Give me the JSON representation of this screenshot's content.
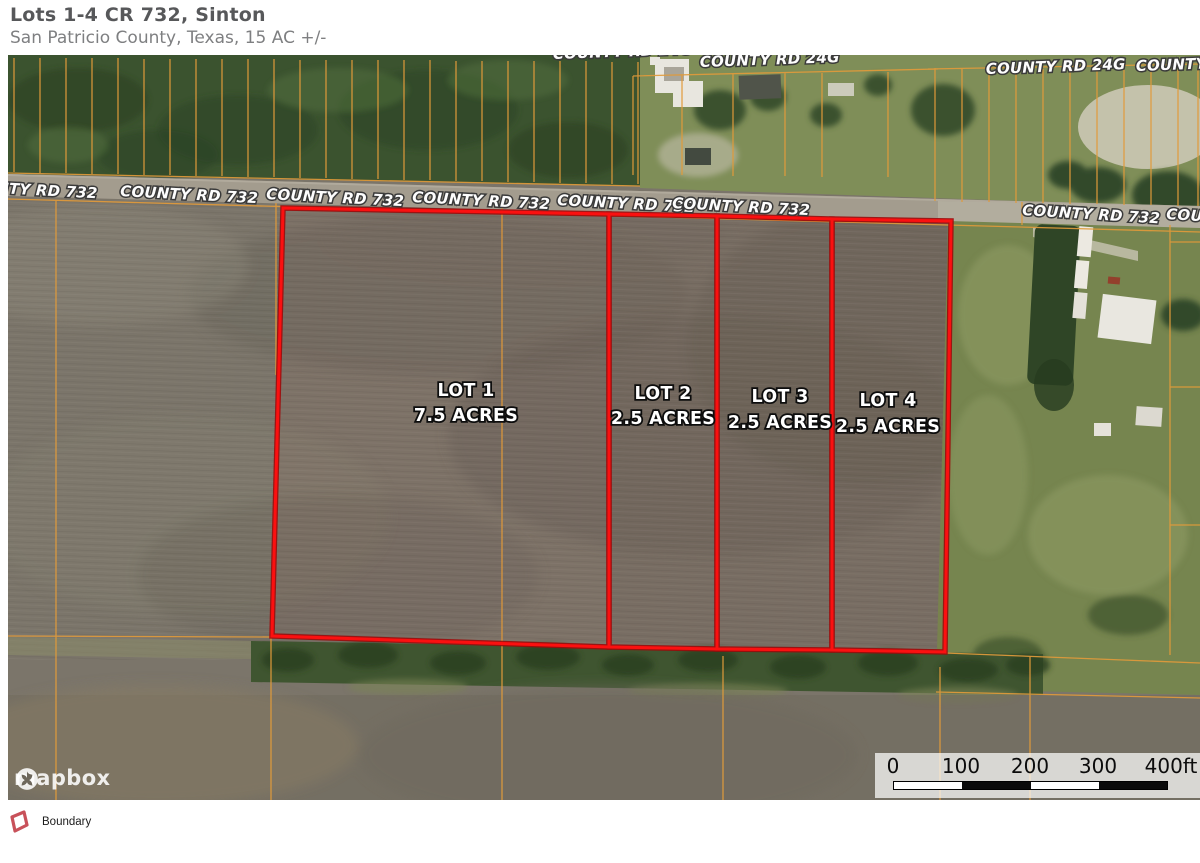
{
  "header": {
    "title": "Lots 1-4 CR 732, Sinton",
    "subtitle": "San Patricio County, Texas, 15 AC +/-"
  },
  "map": {
    "road_24g_labels": [
      "COUNTY RD 24G",
      "COUNTY RD 24G",
      "COUNTY RD 24G",
      "COUNTY"
    ],
    "road_732_labels": [
      "NTY RD 732",
      "COUNTY RD 732",
      "COUNTY RD 732",
      "COUNTY RD 732",
      "COUNTY RD 732",
      "COUNTY RD 732",
      "COUNTY RD 732",
      "COU"
    ],
    "lots": [
      {
        "name": "LOT 1",
        "acres": "7.5 ACRES"
      },
      {
        "name": "LOT 2",
        "acres": "2.5 ACRES"
      },
      {
        "name": "LOT 3",
        "acres": "2.5 ACRES"
      },
      {
        "name": "LOT 4",
        "acres": "2.5 ACRES"
      }
    ],
    "scale_bar": {
      "ticks": [
        "0",
        "100",
        "200",
        "300",
        "400ft"
      ]
    },
    "attribution": "mapbox"
  },
  "legend": {
    "items": [
      {
        "label": "Boundary",
        "color": "#c8515a"
      }
    ]
  },
  "colors": {
    "boundary_red": "#fb0d0d",
    "parcel_orange": "#e19b3b",
    "legend_red": "#c8515a"
  }
}
